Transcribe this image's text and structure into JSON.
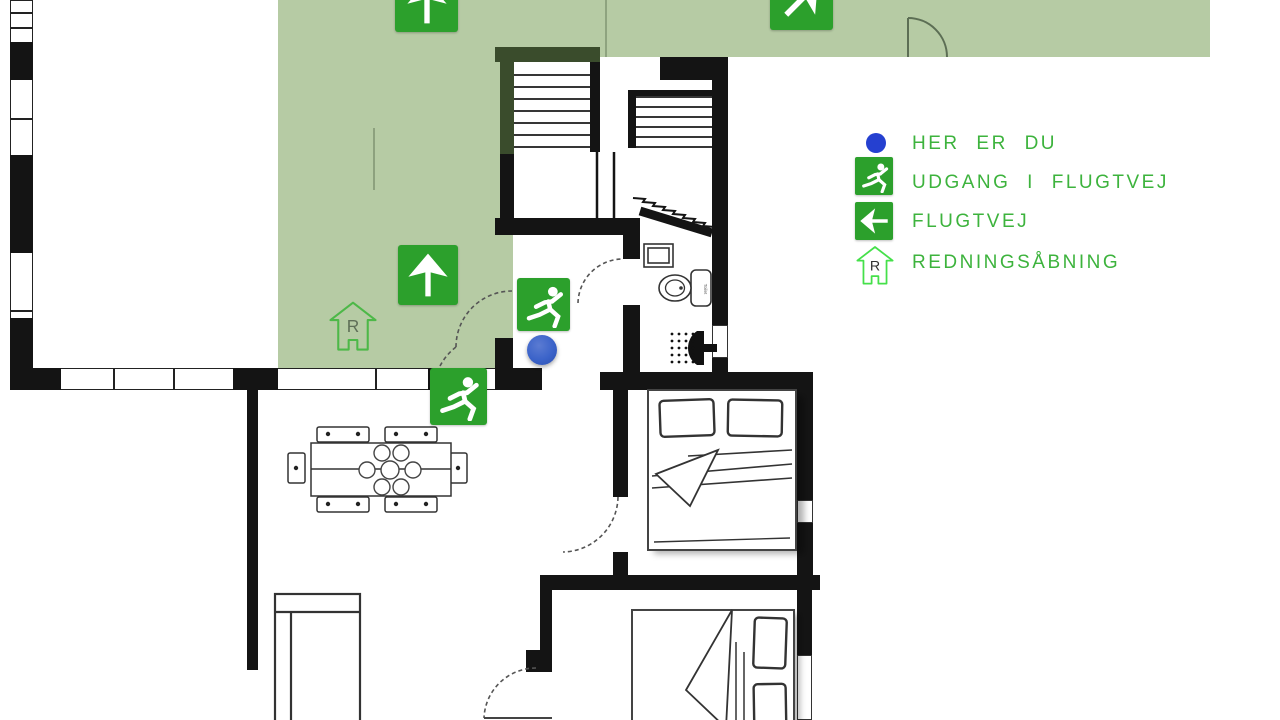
{
  "legend": {
    "items": [
      {
        "icon": "here-dot-icon",
        "label": "HER ER DU"
      },
      {
        "icon": "exit-running-man-icon",
        "label": "UDGANG I FLUGTVEJ"
      },
      {
        "icon": "escape-route-arrow-icon",
        "label": "FLUGTVEJ"
      },
      {
        "icon": "rescue-opening-icon",
        "label": "REDNINGSÅBNING"
      }
    ]
  },
  "plan": {
    "rescue_marker_letter": "R",
    "toilet_label": "Toilet"
  },
  "colors": {
    "route_overlay_green": "#b6cba4",
    "sign_green": "#2ca02c",
    "legend_text_green": "#3db33d",
    "legend_dot_blue": "#2540d0",
    "you_are_here_blue": "#3b63c9",
    "wall_black": "#141414",
    "rescue_outline_green": "#4db848"
  }
}
